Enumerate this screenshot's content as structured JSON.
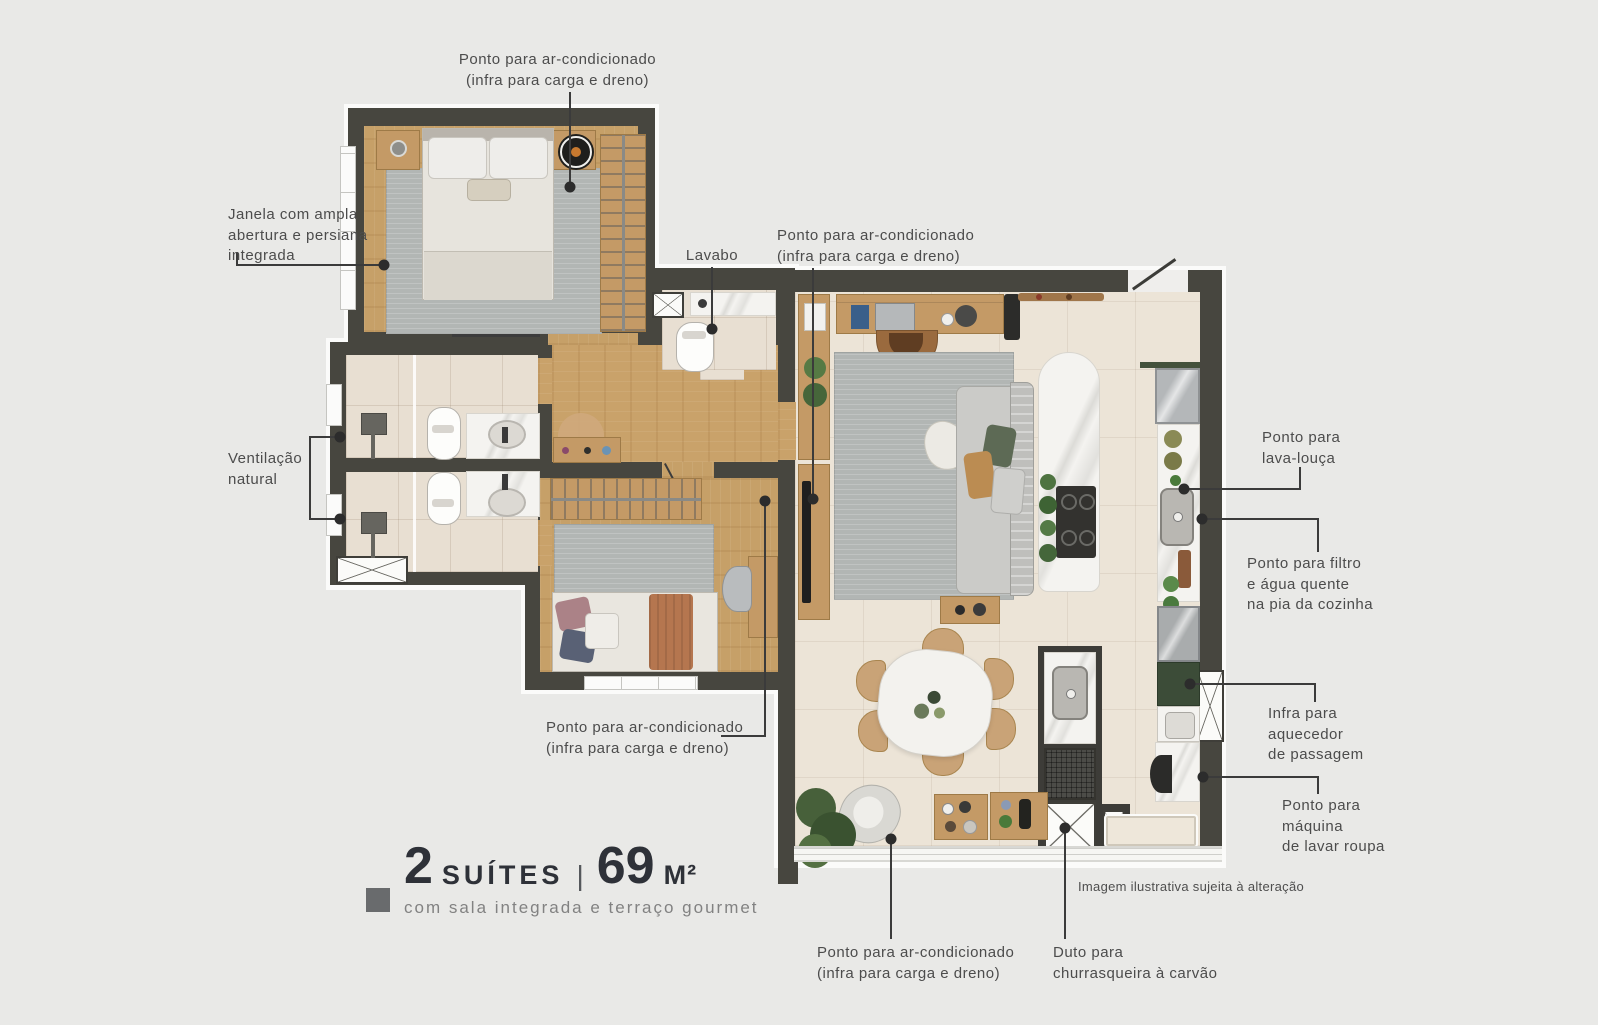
{
  "background_color": "#e9e9e7",
  "title": {
    "number": "2",
    "type_label": "SUÍTES",
    "separator": "|",
    "area_value": "69",
    "area_unit": "M²",
    "subtitle": "com sala integrada e terraço gourmet"
  },
  "disclaimer": "Imagem ilustrativa sujeita à alteração",
  "annotations": {
    "ac_suite1": "Ponto para ar-condicionado\n(infra para carga e dreno)",
    "janela": "Janela com ampla\nabertura e persiana\nintegrada",
    "ventilacao": "Ventilação\nnatural",
    "lavabo": "Lavabo",
    "ac_living": "Ponto para ar-condicionado\n(infra para carga e dreno)",
    "lava_louca": "Ponto para\nlava-louça",
    "filtro": "Ponto para filtro\ne água quente\nna pia da cozinha",
    "aquecedor": "Infra para\naquecedor\nde passagem",
    "maquina": "Ponto para\nmáquina\nde lavar roupa",
    "ac_suite2": "Ponto para ar-condicionado\n(infra para carga e dreno)",
    "ac_terraco": "Ponto para ar-condicionado\n(infra para carga e dreno)",
    "duto": "Duto para\nchurrasqueira à carvão"
  },
  "colors": {
    "wall": "#47463f",
    "wood_floor": "#c9a26a",
    "bathroom_floor": "#e8dfd2",
    "living_floor": "#ece4d7",
    "rug": "#b2b6b4",
    "marble": "#f4f3f0",
    "cabinet_green": "#3c4c38",
    "annotation_text": "#4c4c4c",
    "title_text": "#2e3138",
    "leader_line": "#3b3b3b"
  }
}
